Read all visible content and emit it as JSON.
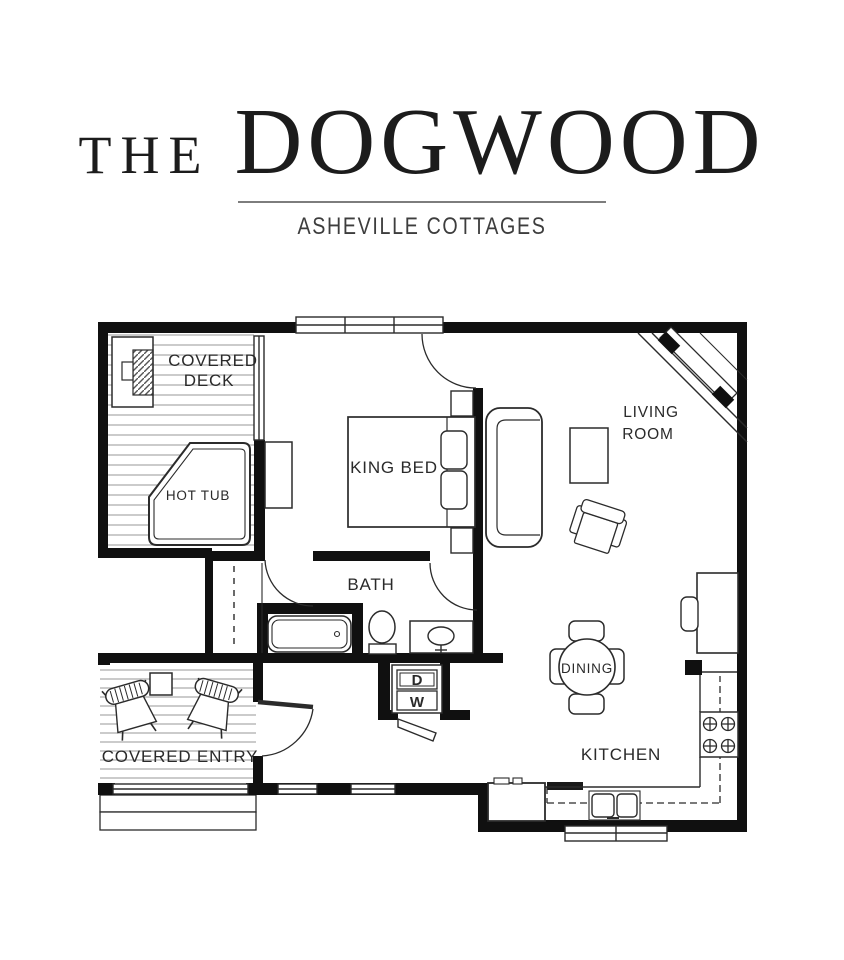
{
  "header": {
    "title_prefix": "THE",
    "title_main": "DOGWOOD",
    "subtitle": "ASHEVILLE COTTAGES"
  },
  "plan": {
    "labels": {
      "covered_deck_line1": "COVERED",
      "covered_deck_line2": "DECK",
      "hot_tub": "HOT TUB",
      "king_bed": "KING BED",
      "bath": "BATH",
      "living_room_line1": "LIVING",
      "living_room_line2": "ROOM",
      "dining": "DINING",
      "kitchen": "KITCHEN",
      "covered_entry": "COVERED ENTRY",
      "dryer": "D",
      "washer": "W"
    },
    "colors": {
      "wall": "#101010",
      "line": "#2b2b2b",
      "plank": "#a8a8a8",
      "text": "#2a2a2a"
    }
  }
}
